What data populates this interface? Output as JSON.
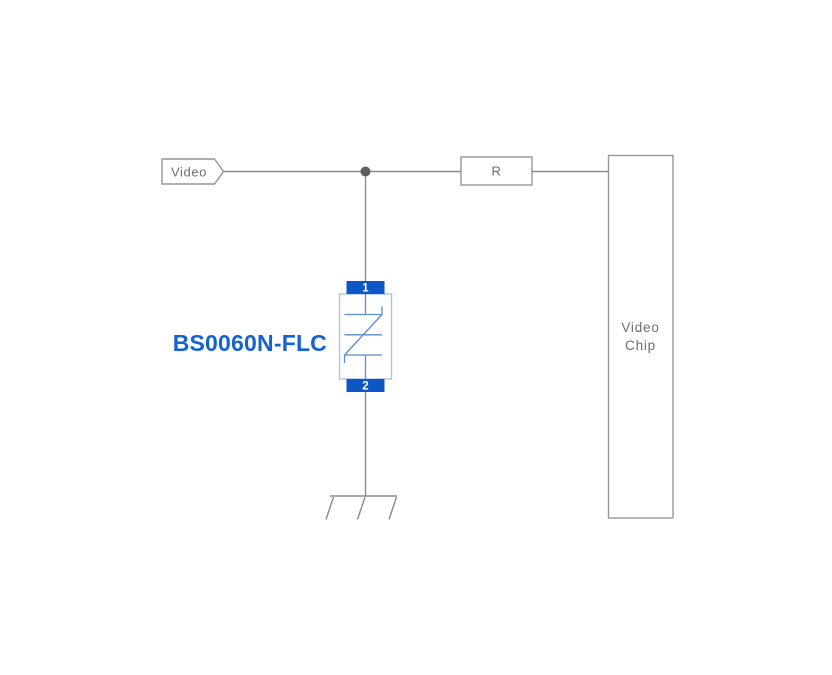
{
  "labels": {
    "net": "Video",
    "resistor": "R",
    "chip": [
      "Video",
      "Chip"
    ],
    "component": "BS0060N-FLC",
    "pin1": "1",
    "pin2": "2"
  },
  "colors": {
    "background": "#ffffff",
    "wire": "#8b8b8b",
    "box_border": "#969696",
    "box_text": "#6e6e6e",
    "junction_dot": "#5d5d5d",
    "pin_pad_fill": "#0d57c5",
    "pin_text": "#ffffff",
    "component_label": "#1463d0",
    "tvs_body_border": "#a9c6e8",
    "tvs_symbol_stroke": "#5c8dcc"
  }
}
